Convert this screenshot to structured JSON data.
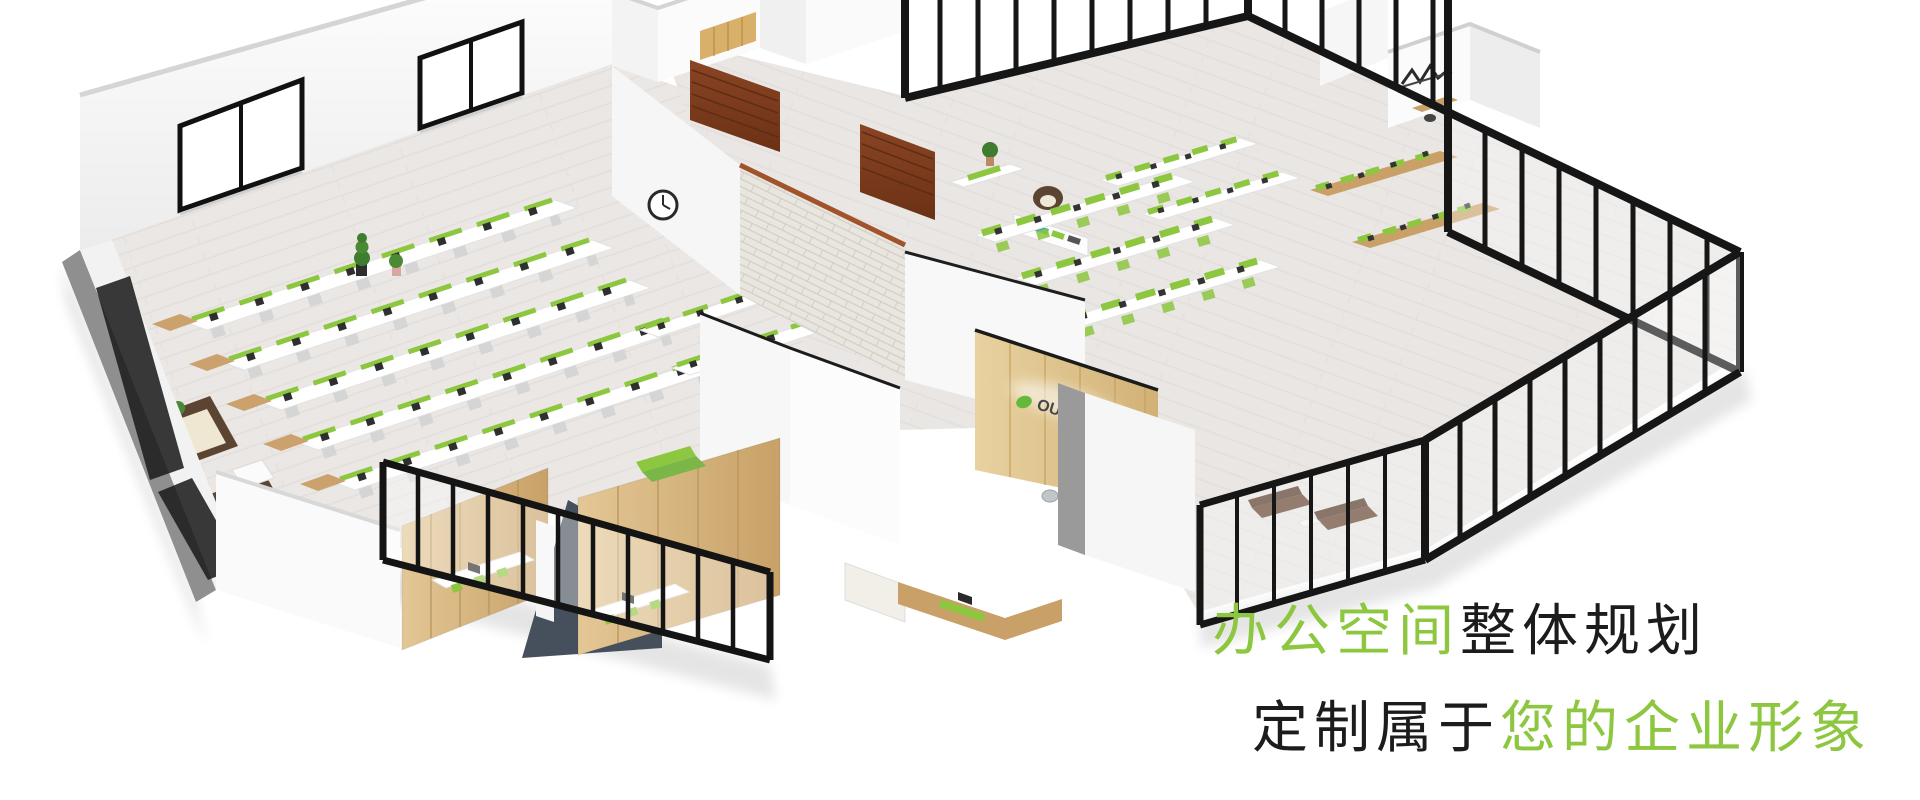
{
  "scene": {
    "label": "isometric-office-floorplan-render",
    "logo": {
      "text": "OUJIN",
      "suffix": "欧进"
    },
    "colors": {
      "accent_green": "#8dc63f",
      "leaf_green": "#65b93a",
      "floor": "#eae7e4",
      "wall_white": "#f8f8f8",
      "wood_light": "#d2ab72",
      "wood_dark": "#7a3c1e",
      "slate_panel": "#46505c",
      "glass_frame": "#161616",
      "sofa_brown": "#5c4433",
      "brick_wall": "#e9e6e0"
    }
  },
  "caption": {
    "line1_green": "办公空间",
    "line1_black": "整体规划",
    "line2_black": "定制属于",
    "line2_green": "您的企业形象"
  }
}
